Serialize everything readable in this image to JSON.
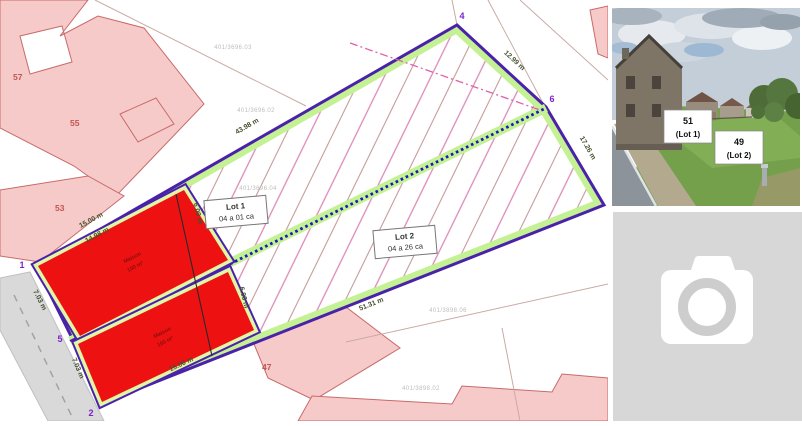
{
  "plan": {
    "lots": [
      {
        "name": "Lot 1",
        "area": "04 a 01 ca"
      },
      {
        "name": "Lot 2",
        "area": "04 a 26 ca"
      }
    ],
    "parcels": {
      "p57": "57",
      "p55": "55",
      "p53": "53",
      "p47": "47"
    },
    "corners": {
      "c1": "1",
      "c2": "2",
      "c4": "4",
      "c5": "5",
      "c6": "6"
    },
    "dims": {
      "top": "43.98 m",
      "upper_right": "12.99 m",
      "right": "17.26 m",
      "bottom": "51.31 m",
      "frontage1": "7.03 m",
      "frontage2": "7.03 m",
      "zoneA_outer": "15.00 m",
      "zoneA_inner": "14.98 m",
      "zoneB": "15.06 m",
      "div_upper": "6.00 m",
      "div_lower": "6.00 m"
    },
    "zones": [
      {
        "line1": "Maison",
        "line2": "150 m²"
      },
      {
        "line1": "Maison",
        "line2": "150 m²"
      }
    ],
    "refs": [
      "401/3696.03",
      "401/3696.02",
      "401/3696.04",
      "401/3898.06",
      "401/3898.02"
    ]
  },
  "photo": {
    "labels": [
      {
        "number": "51",
        "lot": "(Lot 1)"
      },
      {
        "number": "49",
        "lot": "(Lot 2)"
      }
    ]
  },
  "colors": {
    "plot_outline": "#4a22aa",
    "band_green": "#c4f193",
    "zone_red": "#ee1111",
    "dotted_blue": "#1a1ab8",
    "parcel_pink": "#f7caca",
    "hatch_pink": "#db8ab6",
    "placeholder_gray": "#d7d7d7"
  }
}
